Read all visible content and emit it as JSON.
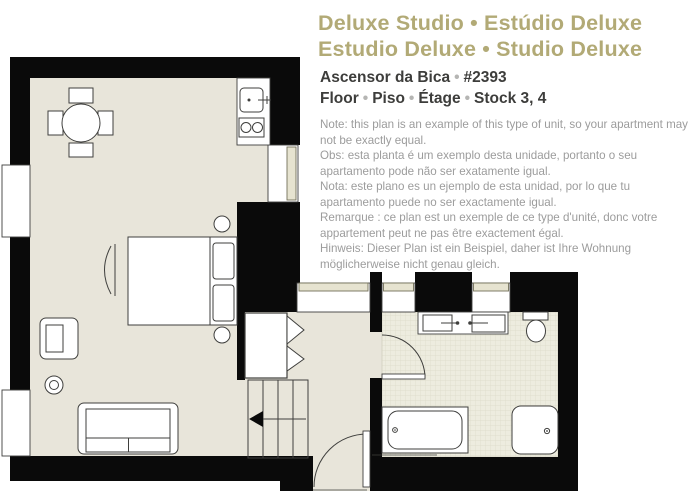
{
  "header": {
    "title_line1": "Deluxe Studio • Estúdio Deluxe",
    "title_line2": "Estudio Deluxe • Studio Deluxe",
    "bullet": "•",
    "unit_name": "Ascensor da Bica",
    "unit_number": "#2393",
    "floor_labels": [
      "Floor",
      "Piso",
      "Étage"
    ],
    "floor_value": "Stock 3, 4"
  },
  "notes": [
    "Note: this plan is an example of this type of unit, so your apartment may not be exactly equal.",
    "Obs: esta planta é um exemplo desta unidade, portanto o seu apartamento pode não ser exatamente igual.",
    "Nota: este plano es un ejemplo de esta unidad, por lo que tu apartamento puede no ser exactamente igual.",
    "Remarque : ce plan est un exemple de ce type d'unité, donc votre appartement peut ne pas être exactement égal.",
    "Hinweis: Dieser Plan ist ein Beispiel, daher ist Ihre Wohnung möglicherweise nicht genau gleich."
  ],
  "colors": {
    "title_gold": "#b2aa76",
    "heading_dark": "#3d3d3b",
    "note_gray": "#9c9c9c",
    "wall_black": "#0a0a0a",
    "floor_beige": "#e8e5da",
    "bathroom_tile": "#edecdf",
    "outline": "#3f3f3d",
    "window_sill": "#e6e3d0"
  },
  "floorplan": {
    "rooms": [
      "studio-room",
      "hallway",
      "staircase",
      "bathroom"
    ],
    "fixtures": [
      "dining-table",
      "dining-chairs",
      "kitchen-counter",
      "kitchen-sink",
      "kitchen-hob",
      "double-bed",
      "pillows",
      "nightstands",
      "radiator",
      "armchair",
      "side-table",
      "sofa",
      "closet",
      "stairs",
      "stairs-direction-arrow",
      "entry-door",
      "bathroom-door",
      "double-sink-vanity",
      "toilet",
      "bathtub",
      "shower",
      "windows"
    ]
  }
}
